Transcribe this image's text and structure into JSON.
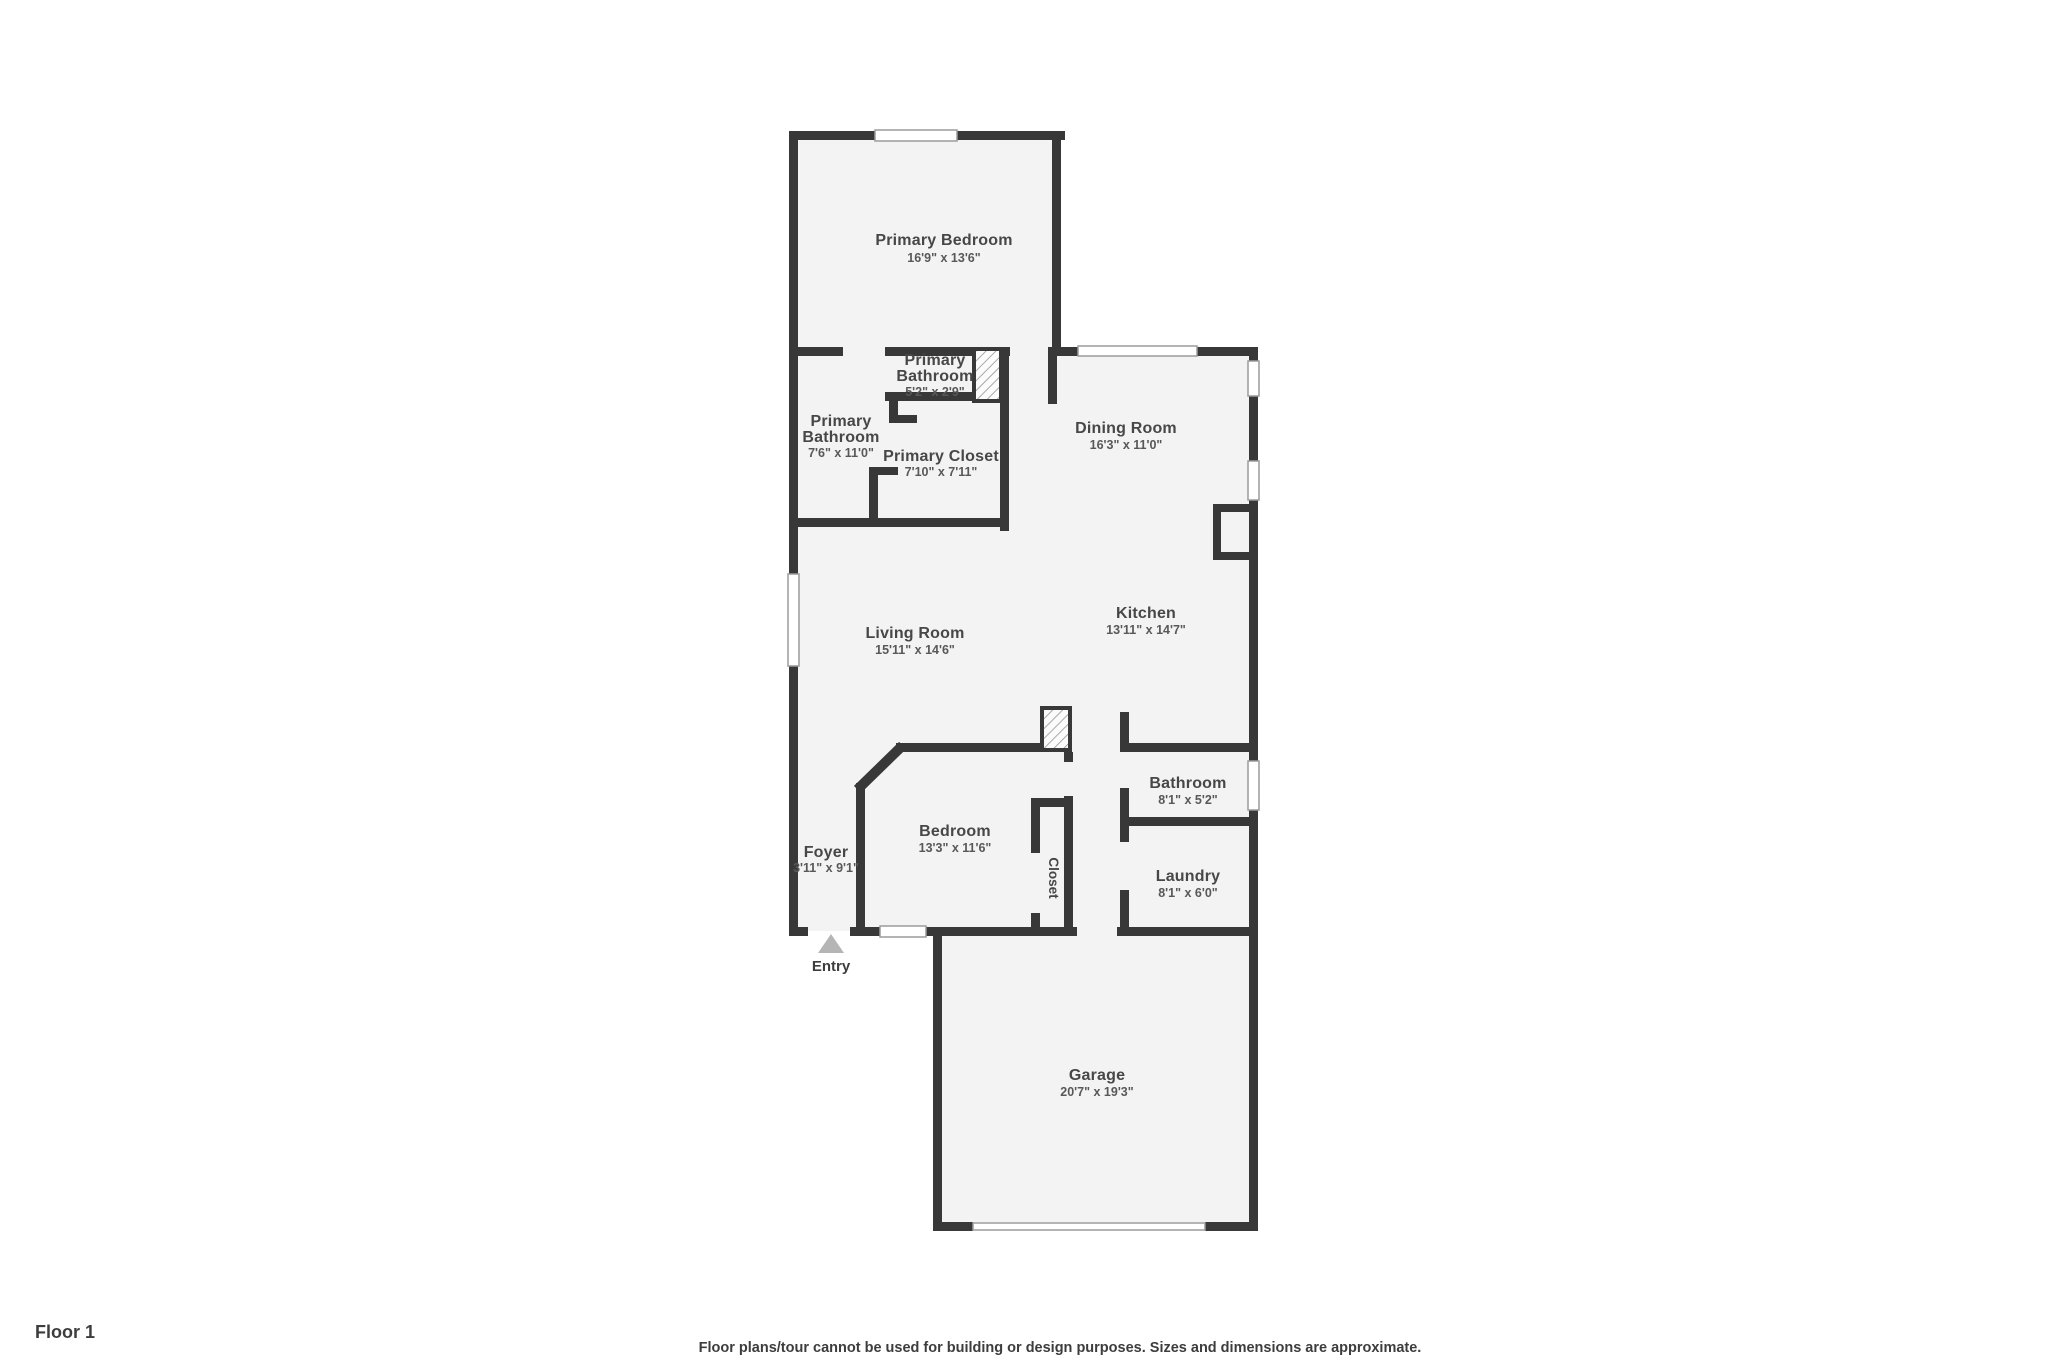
{
  "meta": {
    "floor_label": "Floor 1",
    "disclaimer": "Floor plans/tour cannot be used for building or design purposes. Sizes and dimensions are approximate."
  },
  "entry": {
    "label": "Entry"
  },
  "colors": {
    "wall": "#383838",
    "floor": "#f3f3f3",
    "room_name_text": "#474747",
    "room_dims_text": "#585858",
    "window_line": "#9b9b9b",
    "entry_arrow": "#b5b5b5"
  },
  "rooms": [
    {
      "id": "primary-bedroom",
      "name": "Primary Bedroom",
      "dims": "16'9\" x 13'6\""
    },
    {
      "id": "primary-bathroom-small",
      "name": "Primary Bathroom",
      "name_lines": [
        "Primary",
        "Bathroom"
      ],
      "dims": "5'2\" x 2'9\""
    },
    {
      "id": "primary-bathroom",
      "name": "Primary Bathroom",
      "name_lines": [
        "Primary",
        "Bathroom"
      ],
      "dims": "7'6\" x 11'0\""
    },
    {
      "id": "primary-closet",
      "name": "Primary Closet",
      "dims": "7'10\" x 7'11\""
    },
    {
      "id": "dining-room",
      "name": "Dining Room",
      "dims": "16'3\" x 11'0\""
    },
    {
      "id": "kitchen",
      "name": "Kitchen",
      "dims": "13'11\" x 14'7\""
    },
    {
      "id": "living-room",
      "name": "Living Room",
      "dims": "15'11\" x 14'6\""
    },
    {
      "id": "bathroom",
      "name": "Bathroom",
      "dims": "8'1\" x 5'2\""
    },
    {
      "id": "bedroom",
      "name": "Bedroom",
      "dims": "13'3\" x 11'6\""
    },
    {
      "id": "closet",
      "name": "Closet",
      "dims": ""
    },
    {
      "id": "foyer",
      "name": "Foyer",
      "dims": "3'11\" x 9'1\""
    },
    {
      "id": "laundry",
      "name": "Laundry",
      "dims": "8'1\" x 6'0\""
    },
    {
      "id": "garage",
      "name": "Garage",
      "dims": "20'7\" x 19'3\""
    }
  ]
}
